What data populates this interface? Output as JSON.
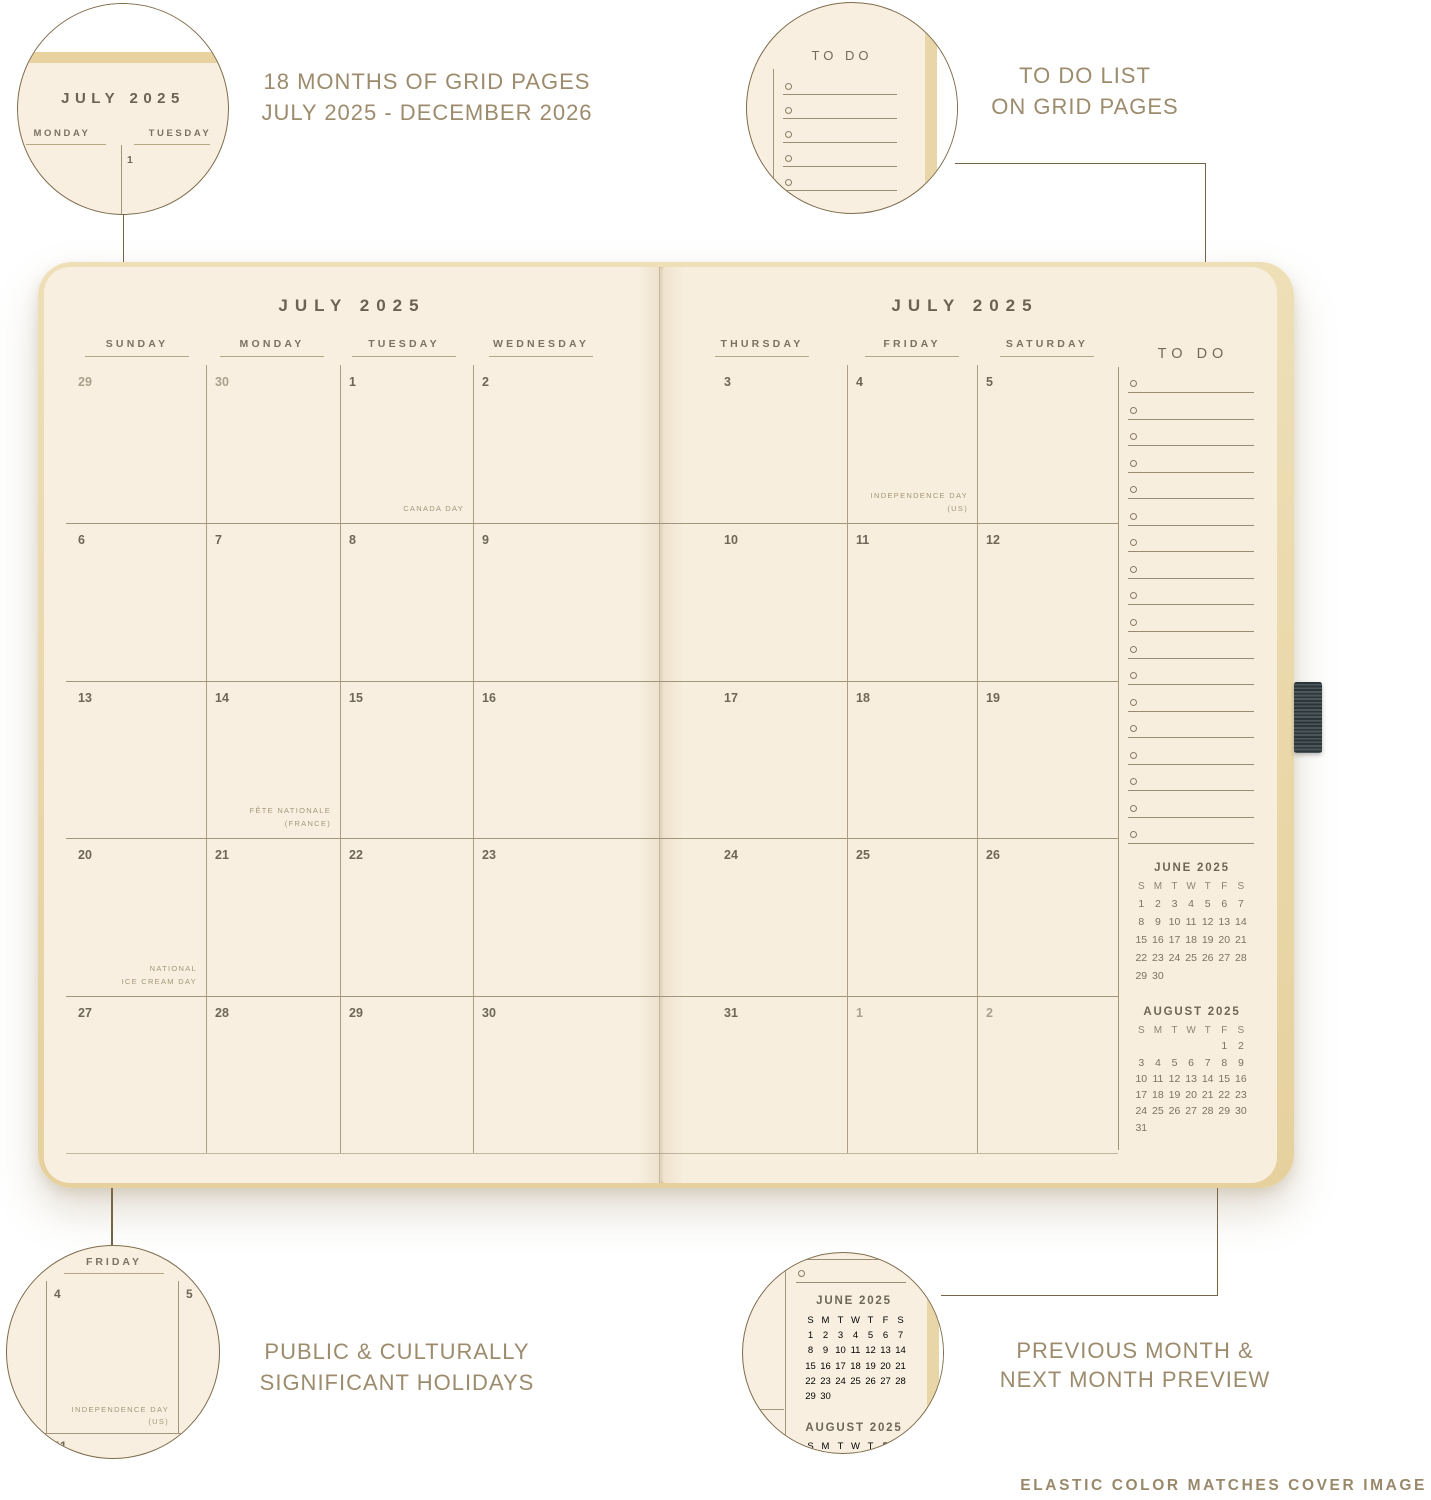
{
  "captions": {
    "months": [
      "18 MONTHS OF GRID PAGES",
      "JULY 2025 - DECEMBER 2026"
    ],
    "todo": [
      "TO DO LIST",
      "ON GRID PAGES"
    ],
    "holidays": [
      "PUBLIC & CULTURALLY",
      "SIGNIFICANT HOLIDAYS"
    ],
    "preview": [
      "PREVIOUS MONTH &",
      "NEXT MONTH PREVIEW"
    ],
    "footer": "ELASTIC COLOR MATCHES COVER IMAGE"
  },
  "planner": {
    "left_title": "JULY 2025",
    "right_title": "JULY 2025",
    "left_days": [
      "SUNDAY",
      "MONDAY",
      "TUESDAY",
      "WEDNESDAY"
    ],
    "right_days": [
      "THURSDAY",
      "FRIDAY",
      "SATURDAY"
    ],
    "left_weeks": [
      [
        {
          "d": "29",
          "m": 1
        },
        {
          "d": "30",
          "m": 1
        },
        {
          "d": "1",
          "h": [
            "CANADA DAY"
          ]
        },
        {
          "d": "2"
        }
      ],
      [
        {
          "d": "6"
        },
        {
          "d": "7"
        },
        {
          "d": "8"
        },
        {
          "d": "9"
        }
      ],
      [
        {
          "d": "13"
        },
        {
          "d": "14",
          "h": [
            "FÊTE NATIONALE",
            "(FRANCE)"
          ]
        },
        {
          "d": "15"
        },
        {
          "d": "16"
        }
      ],
      [
        {
          "d": "20",
          "h": [
            "NATIONAL",
            "ICE CREAM DAY"
          ]
        },
        {
          "d": "21"
        },
        {
          "d": "22"
        },
        {
          "d": "23"
        }
      ],
      [
        {
          "d": "27"
        },
        {
          "d": "28"
        },
        {
          "d": "29"
        },
        {
          "d": "30"
        }
      ]
    ],
    "right_weeks": [
      [
        {
          "d": "3"
        },
        {
          "d": "4",
          "h": [
            "INDEPENDENCE DAY",
            "(US)"
          ]
        },
        {
          "d": "5"
        }
      ],
      [
        {
          "d": "10"
        },
        {
          "d": "11"
        },
        {
          "d": "12"
        }
      ],
      [
        {
          "d": "17"
        },
        {
          "d": "18"
        },
        {
          "d": "19"
        }
      ],
      [
        {
          "d": "24"
        },
        {
          "d": "25"
        },
        {
          "d": "26"
        }
      ],
      [
        {
          "d": "31"
        },
        {
          "d": "1",
          "m": 1
        },
        {
          "d": "2",
          "m": 1
        }
      ]
    ],
    "todo_title": "TO DO",
    "todo_count": 18,
    "minis": [
      {
        "title": "JUNE 2025",
        "days": [
          "S",
          "M",
          "T",
          "W",
          "T",
          "F",
          "S"
        ],
        "weeks": [
          [
            "1",
            "2",
            "3",
            "4",
            "5",
            "6",
            "7"
          ],
          [
            "8",
            "9",
            "10",
            "11",
            "12",
            "13",
            "14"
          ],
          [
            "15",
            "16",
            "17",
            "18",
            "19",
            "20",
            "21"
          ],
          [
            "22",
            "23",
            "24",
            "25",
            "26",
            "27",
            "28"
          ],
          [
            "29",
            "30",
            "",
            "",
            "",
            "",
            ""
          ]
        ]
      },
      {
        "title": "AUGUST 2025",
        "days": [
          "S",
          "M",
          "T",
          "W",
          "T",
          "F",
          "S"
        ],
        "weeks": [
          [
            "",
            "",
            "",
            "",
            "",
            "1",
            "2"
          ],
          [
            "3",
            "4",
            "5",
            "6",
            "7",
            "8",
            "9"
          ],
          [
            "10",
            "11",
            "12",
            "13",
            "14",
            "15",
            "16"
          ],
          [
            "17",
            "18",
            "19",
            "20",
            "21",
            "22",
            "23"
          ],
          [
            "24",
            "25",
            "26",
            "27",
            "28",
            "29",
            "30"
          ],
          [
            "31",
            "",
            "",
            "",
            "",
            "",
            ""
          ]
        ]
      }
    ]
  },
  "callouts": {
    "month_zoom": {
      "title": "JULY 2025",
      "days": [
        "MONDAY",
        "TUESDAY"
      ],
      "date": "1"
    },
    "todo_zoom": {
      "title": "TO DO",
      "count": 5
    },
    "holiday_zoom": {
      "day": "FRIDAY",
      "left_date": "4",
      "right_date": "5",
      "holiday": [
        "INDEPENDENCE DAY",
        "(US)"
      ],
      "next_date": "11"
    }
  },
  "colors": {
    "page_cream": "#f8efe0",
    "cover_tan": "#e9d5a4",
    "grid_line": "#a3957b",
    "connector": "#756446",
    "ink": "#6e6659",
    "caption": "#9c8b6c",
    "elastic": "#394346"
  }
}
